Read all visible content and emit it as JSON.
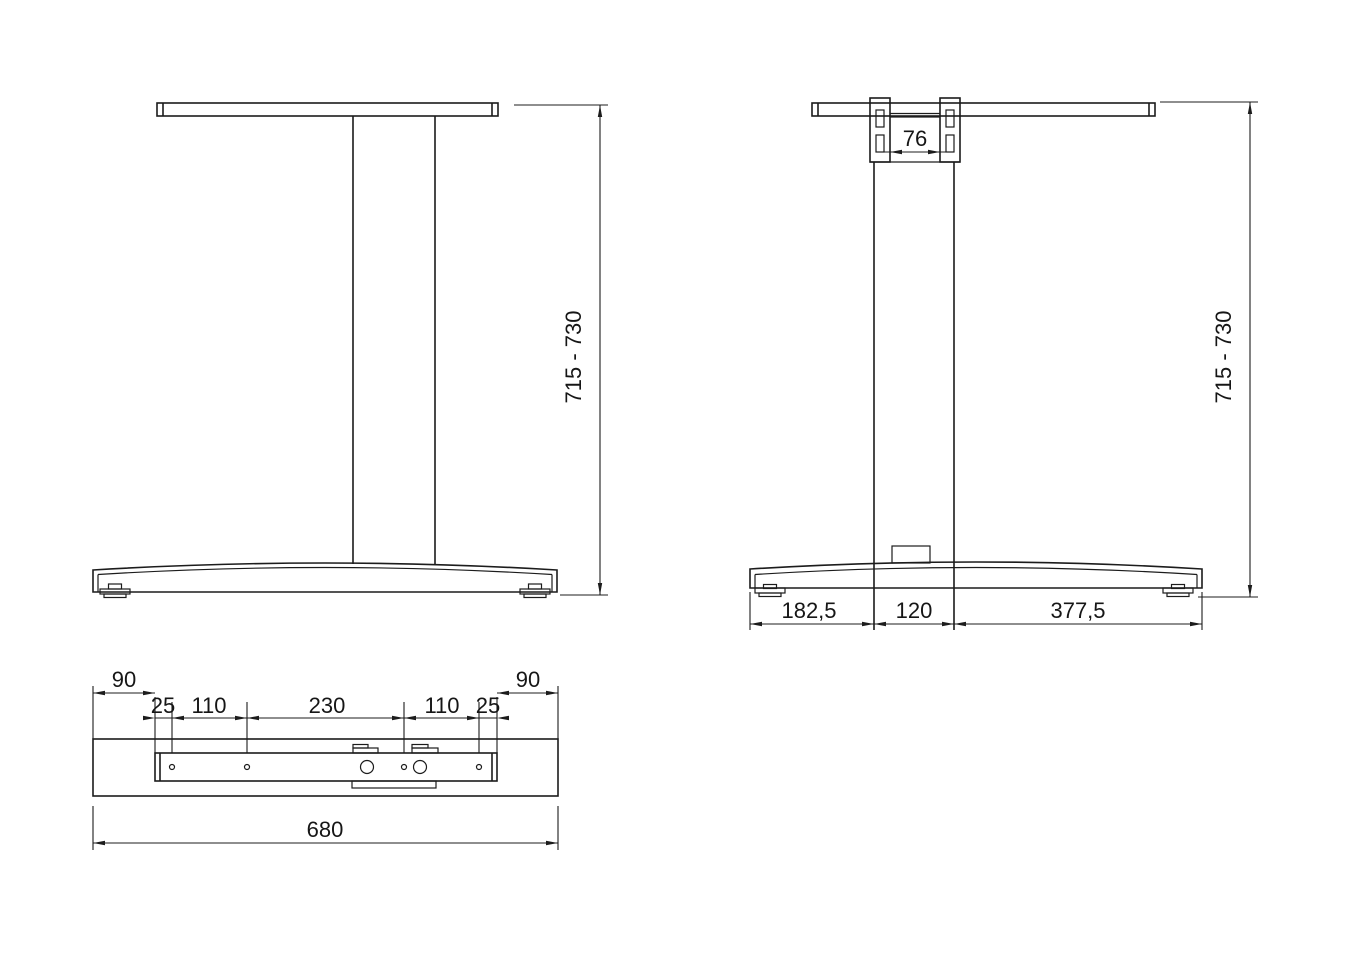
{
  "front_view": {
    "height_range": "715 - 730"
  },
  "side_view": {
    "bracket_inner_width": "76",
    "height_range": "715 - 730",
    "foot_front_segment": "182,5",
    "column_depth": "120",
    "foot_rear_segment": "377,5"
  },
  "top_view": {
    "end_offset_left": "90",
    "end_offset_right": "90",
    "chain": [
      "25",
      "110",
      "230",
      "110",
      "25"
    ],
    "overall_length": "680"
  },
  "colors": {
    "ink": "#1c1c1c",
    "background": "#ffffff"
  }
}
